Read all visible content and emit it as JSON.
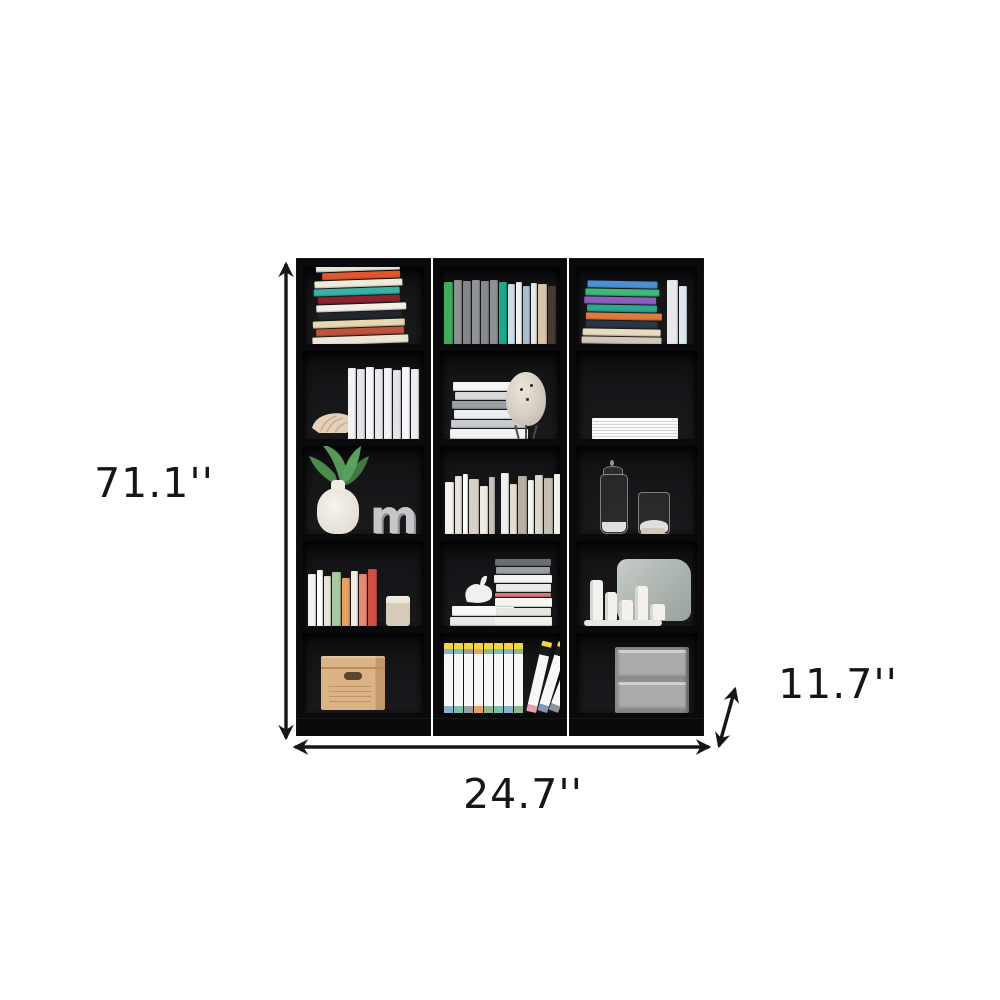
{
  "page": {
    "type": "product-dimension-diagram",
    "background_color": "#ffffff",
    "annotation_color": "#161616"
  },
  "dimensions": {
    "height_label": "71.1''",
    "width_label": "24.7''",
    "depth_label": "11.7''"
  },
  "bookcase": {
    "finish_color": "#0a0a0c",
    "columns": 3,
    "shelves_per_column": 5,
    "decor_letter": "m",
    "shelf_contents": [
      {
        "row": 1,
        "cells": [
          "leaning-pile-of-colorful-books",
          "row-of-vertical-books-green-gray-teal-blue-tan",
          "stacked-colorful-books-with-white-vertical-books"
        ]
      },
      {
        "row": 2,
        "cells": [
          "conch-shell-and-white-magazines",
          "stack-of-white-books-and-egg-shaped-tripod-lamp",
          "stack-of-white-papers"
        ]
      },
      {
        "row": 3,
        "cells": [
          "white-vase-with-plant-and-gray-letter-m",
          "row-of-white-and-beige-books",
          "two-glass-apothecary-jars"
        ]
      },
      {
        "row": 4,
        "cells": [
          "pastel-vertical-books-and-candle-jar",
          "white-bird-figurine-on-books-and-book-stack",
          "mirror-with-pillar-candles-on-tray"
        ]
      },
      {
        "row": 5,
        "cells": [
          "kraft-storage-box",
          "white-binders-with-yellow-and-colorful-labels",
          "gray-two-drawer-cabinet"
        ]
      }
    ]
  }
}
